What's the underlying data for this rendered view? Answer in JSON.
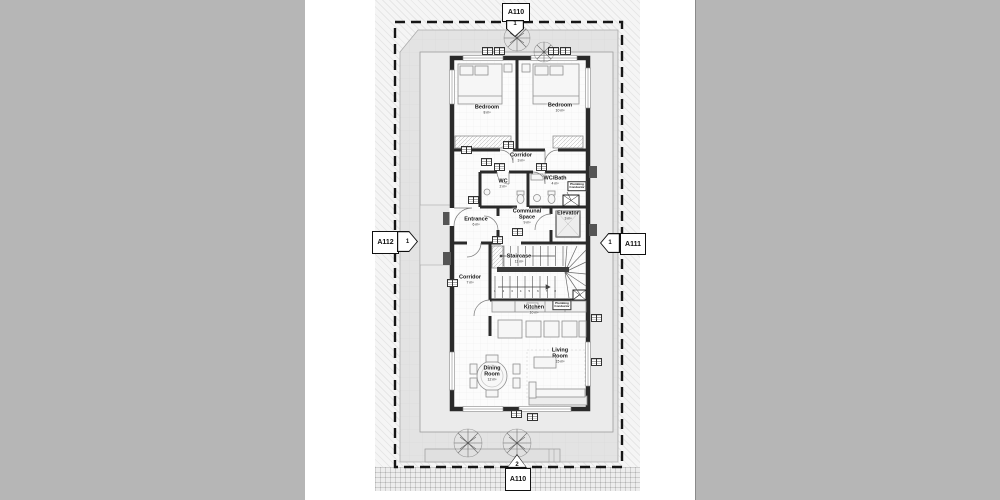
{
  "markers": {
    "top": {
      "sheet": "A110",
      "detail": "1"
    },
    "bottom": {
      "sheet": "A110",
      "detail": "2"
    },
    "left": {
      "sheet": "A112",
      "detail": "1"
    },
    "right": {
      "sheet": "A111",
      "detail": "1"
    }
  },
  "rooms": [
    {
      "name": "Bedroom",
      "area": "8 m²"
    },
    {
      "name": "Bedroom",
      "area": "10 m²"
    },
    {
      "name": "Corridor",
      "area": "3 m²"
    },
    {
      "name": "WC",
      "area": "2 m²"
    },
    {
      "name": "WC/Bath",
      "area": "4 m²"
    },
    {
      "name": "Entrance",
      "area": "6 m²"
    },
    {
      "name": "Communal Space",
      "area": "9 m²"
    },
    {
      "name": "Elevator",
      "area": "3 m²"
    },
    {
      "name": "Staircase",
      "area": "11 m²"
    },
    {
      "name": "Corridor",
      "area": "7 m²"
    },
    {
      "name": "Kitchen",
      "area": "10 m²"
    },
    {
      "name": "Living Room",
      "area": "15 m²"
    },
    {
      "name": "Dining Room",
      "area": "12 m²"
    }
  ],
  "notes": {
    "plumbing_line1": "Plumbing",
    "plumbing_line2": "Conductor"
  },
  "stairs": {
    "numbers": [
      "1",
      "2",
      "3",
      "4",
      "5",
      "6",
      "7",
      "8"
    ]
  },
  "colors": {
    "wall": "#2a2a2a",
    "boundary_dash": "#161616",
    "site_fill": "#e3e3e3",
    "terrace_fill": "#ebebeb",
    "page_margin": "#b6b6b6"
  }
}
